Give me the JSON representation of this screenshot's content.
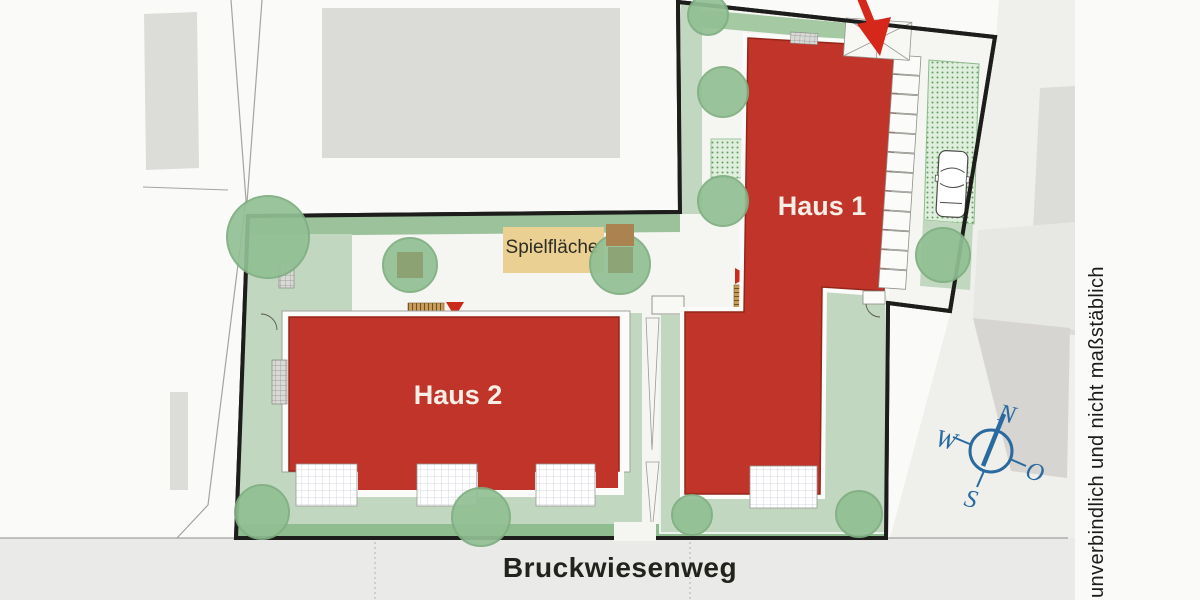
{
  "plan": {
    "buildings": {
      "haus1": "Haus 1",
      "haus2": "Haus 2"
    },
    "playground_label": "Spielfläche",
    "street_name": "Bruckwiesenweg",
    "disclaimer": "unverbindlich und nicht maßstäblich",
    "compass": {
      "north": "N",
      "east": "O",
      "south": "S",
      "west": "W"
    },
    "colors": {
      "building_red": "#c0342a",
      "building_red_outline": "#932619",
      "arrow_red": "#d6281a",
      "garden_green": "#c2d7bf",
      "strip_green": "#9cc29c",
      "street_strip_green": "#8fbd8f",
      "tree_green": "#92c094",
      "playground_tan": "#ead092",
      "neighbor_gray": "#dbdbd7",
      "street_gray": "#eaeae8",
      "boundary_black": "#1d1d1b",
      "compass_blue": "#2a6a9f"
    }
  }
}
